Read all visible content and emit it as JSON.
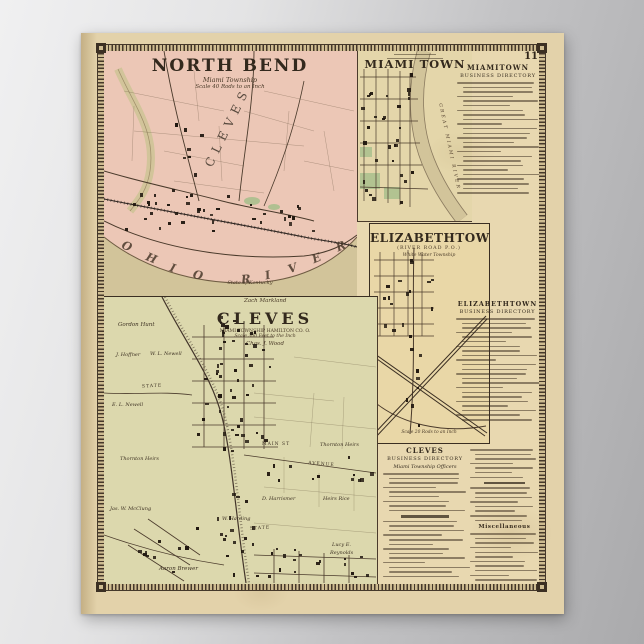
{
  "page": {
    "number": "11"
  },
  "maps": {
    "north_bend": {
      "title": "NORTH BEND",
      "subtitle": "Miami Township",
      "scale_note": "Scale 40 Rods to an Inch",
      "area_label": "CLEVES",
      "river_label": "OHIO RIVER",
      "river_note": "State of Kentucky"
    },
    "miami_town": {
      "title": "MIAMI TOWN",
      "river_label": "GREAT MIAMI RIVER"
    },
    "elizabethtown": {
      "title": "ELIZABETHTOWN",
      "subtitle": "(RIVER ROAD P.O.)",
      "township": "White Water Township",
      "scale_note": "Scale 20 Rods to an Inch"
    },
    "cleves": {
      "title": "CLEVES",
      "township_note": "MIAMI TOWNSHIP HAMILTON CO. O.",
      "scale_note": "Scale 300 Feet to the Inch",
      "credit": "Chas. J. Wood",
      "top_label": "Zach Markland",
      "labels": [
        {
          "t": "Gordon Hunt",
          "x": 14,
          "y": 26,
          "s": 5.5,
          "r": 0,
          "i": 1
        },
        {
          "t": "J. Hoffner",
          "x": 12,
          "y": 56,
          "s": 5,
          "r": 0,
          "i": 1
        },
        {
          "t": "W. L. Newell",
          "x": 46,
          "y": 55,
          "s": 5,
          "r": 0,
          "i": 1
        },
        {
          "t": "E. L. Newell",
          "x": 8,
          "y": 106,
          "s": 5,
          "r": 0,
          "i": 1
        },
        {
          "t": "STATE",
          "x": 38,
          "y": 88,
          "s": 4.5,
          "r": -3,
          "i": 0
        },
        {
          "t": "STATE",
          "x": 146,
          "y": 230,
          "s": 4.5,
          "r": -3,
          "i": 0
        },
        {
          "t": "MAIN ST",
          "x": 158,
          "y": 146,
          "s": 4.5,
          "r": 0,
          "i": 0
        },
        {
          "t": "AVENUE",
          "x": 204,
          "y": 166,
          "s": 4.5,
          "r": 5,
          "i": 0
        },
        {
          "t": "Thornton Heirs",
          "x": 16,
          "y": 160,
          "s": 5,
          "r": 0,
          "i": 1
        },
        {
          "t": "Thornton Heirs",
          "x": 216,
          "y": 146,
          "s": 5,
          "r": 0,
          "i": 1
        },
        {
          "t": "Jas. W. McClung",
          "x": 6,
          "y": 210,
          "s": 5,
          "r": 0,
          "i": 1
        },
        {
          "t": "D. Harrismer",
          "x": 158,
          "y": 200,
          "s": 5,
          "r": 0,
          "i": 1
        },
        {
          "t": "Heirs Rice",
          "x": 219,
          "y": 200,
          "s": 5,
          "r": 0,
          "i": 1
        },
        {
          "t": "W. Harding",
          "x": 118,
          "y": 220,
          "s": 5,
          "r": 0,
          "i": 1
        },
        {
          "t": "Aaron Brewer",
          "x": 55,
          "y": 270,
          "s": 5.5,
          "r": 0,
          "i": 1
        },
        {
          "t": "Lucy E.",
          "x": 228,
          "y": 246,
          "s": 5,
          "r": 0,
          "i": 1
        },
        {
          "t": "Reynolds",
          "x": 226,
          "y": 254,
          "s": 5,
          "r": 0,
          "i": 1
        }
      ]
    }
  },
  "directories": {
    "miamitown": {
      "line1": "MIAMITOWN",
      "line2": "BUSINESS DIRECTORY"
    },
    "elizabethtown": {
      "line1": "ELIZABETHTOWN",
      "line2": "BUSINESS DIRECTORY"
    },
    "cleves": {
      "line1": "CLEVES",
      "line2": "BUSINESS DIRECTORY",
      "section": "Miami Township Officers"
    },
    "misc": "Miscellaneous"
  }
}
